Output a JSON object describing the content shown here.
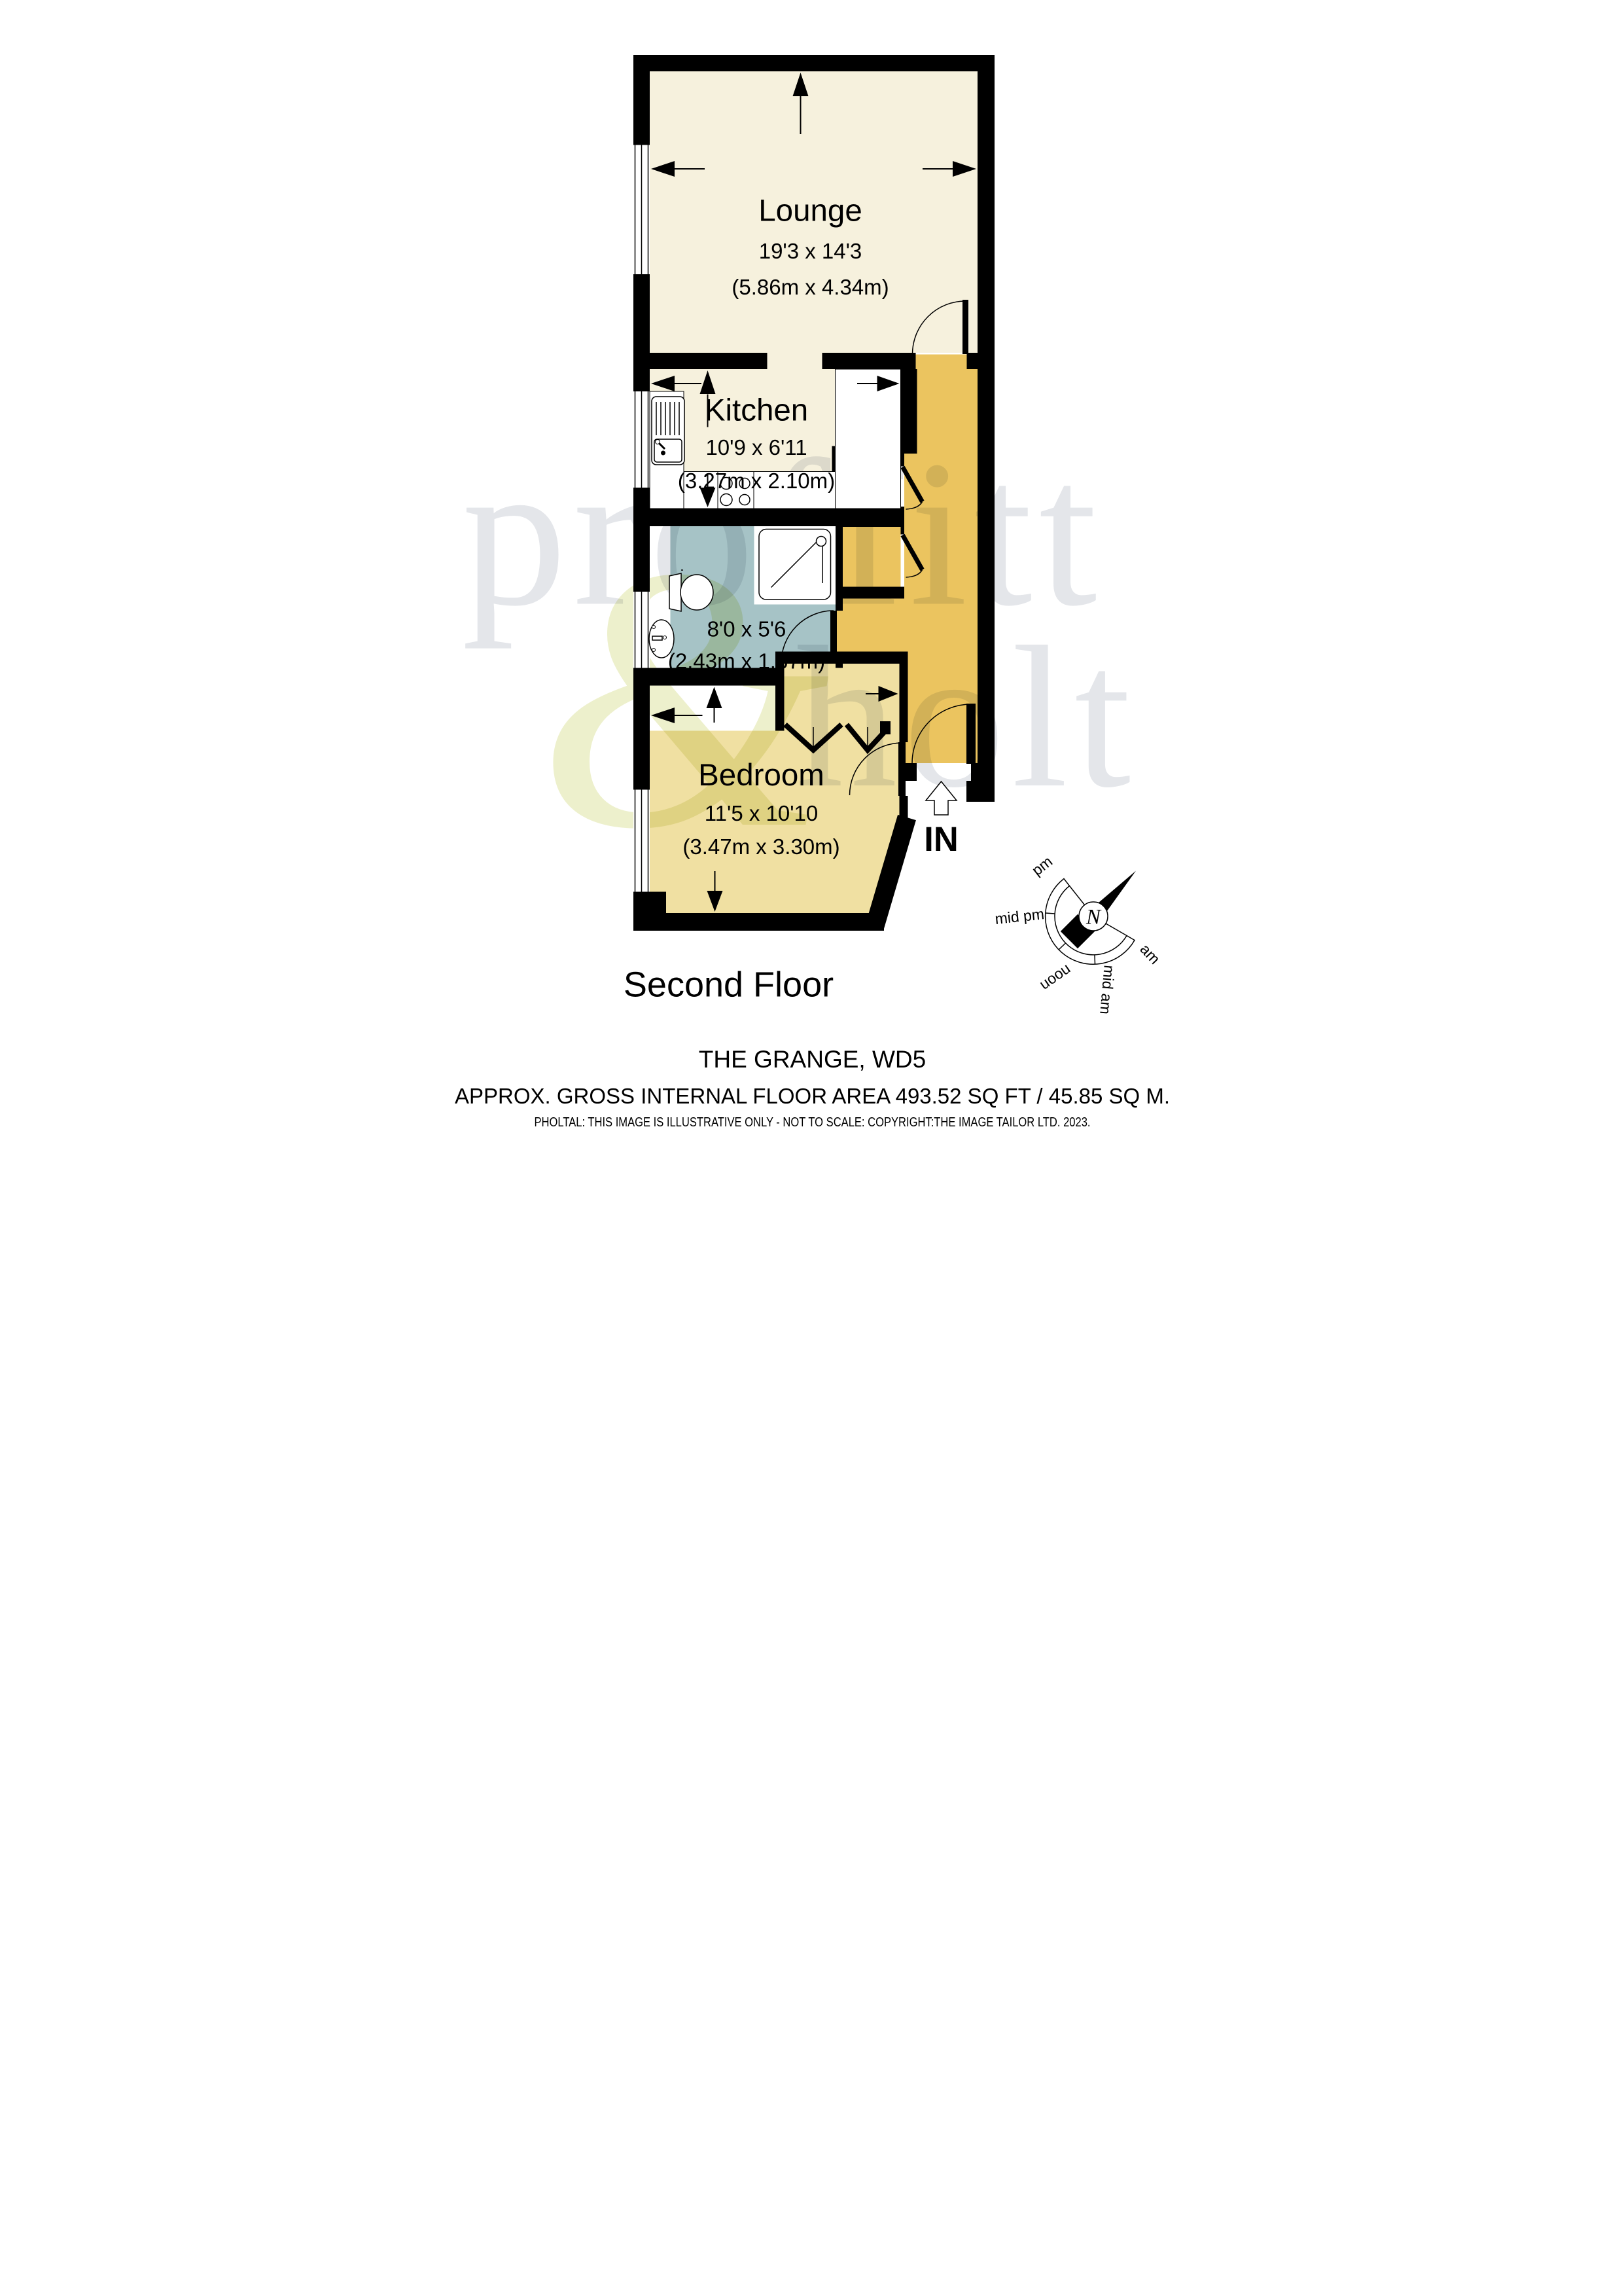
{
  "floorplan": {
    "floor_label": "Second Floor",
    "entrance_label": "IN",
    "rooms": [
      {
        "name": "Lounge",
        "size_imperial": "19'3 x 14'3",
        "size_metric": "(5.86m x 4.34m)"
      },
      {
        "name": "Kitchen",
        "size_imperial": "10'9 x 6'11",
        "size_metric": "(3.27m x 2.10m)"
      },
      {
        "name": "",
        "size_imperial": "8'0 x 5'6",
        "size_metric": "(2.43m x 1.67m)"
      },
      {
        "name": "Bedroom",
        "size_imperial": "11'5 x 10'10",
        "size_metric": "(3.47m x 3.30m)"
      }
    ]
  },
  "compass": {
    "north": "N",
    "labels": [
      "pm",
      "mid pm",
      "noon",
      "mid am",
      "am"
    ]
  },
  "watermark": {
    "line1": "proffitt",
    "ampersand": "&",
    "line2": "holt"
  },
  "footer": {
    "title": "THE GRANGE, WD5",
    "area": "APPROX. GROSS INTERNAL FLOOR AREA 493.52 SQ FT / 45.85 SQ M.",
    "disclaimer": "PHOLTAL: THIS IMAGE IS ILLUSTRATIVE ONLY - NOT TO SCALE: COPYRIGHT:THE IMAGE TAILOR LTD. 2023."
  },
  "colors": {
    "lounge_kitchen_fill": "#F6F1DD",
    "hallway_fill": "#EBC45F",
    "bedroom_fill": "#F0E0A2",
    "bathroom_fill": "#A6C3C6",
    "wall": "#000000",
    "watermark_gray": "#E4E6EA",
    "watermark_green": "#EDF0CC"
  }
}
